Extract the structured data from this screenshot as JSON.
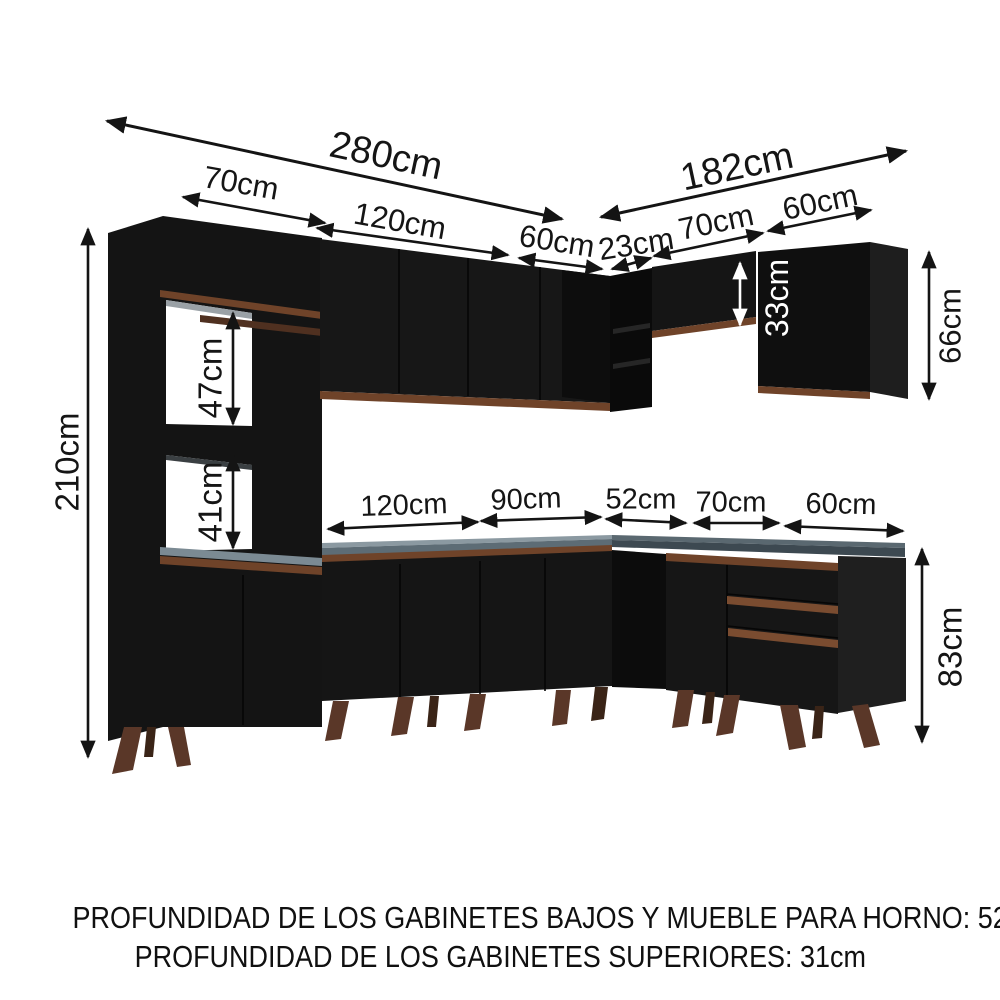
{
  "diagram": {
    "type": "kitchen-cabinet-dimension-diagram",
    "dimensions": {
      "left_run_total": "280cm",
      "right_run_total": "182cm",
      "top_row": {
        "tall_cabinet_width": "70cm",
        "upper_cabinet_120": "120cm",
        "upper_cabinet_60": "60cm",
        "corner_shelf_width": "23cm",
        "upper_cabinet_70": "70cm",
        "upper_cabinet_60_right": "60cm"
      },
      "heights": {
        "tall_cabinet_height": "210cm",
        "upper_niche": "47cm",
        "lower_niche": "41cm",
        "small_upper_cabinet": "33cm",
        "large_upper_cabinet": "66cm",
        "base_cabinet_height": "83cm"
      },
      "counter_row": {
        "base_120": "120cm",
        "base_90": "90cm",
        "base_52": "52cm",
        "base_70": "70cm",
        "base_60": "60cm"
      }
    },
    "footnotes": {
      "line1": "PROFUNDIDAD DE LOS GABINETES BAJOS Y MUEBLE PARA HORNO: 52cm",
      "line2": "PROFUNDIDAD DE LOS GABINETES SUPERIORES: 31cm"
    },
    "colors": {
      "cabinet_black": "#141414",
      "wood_trim": "#6f4329",
      "drawer_trim": "#7a4c30",
      "countertop_left": "#5d6c75",
      "countertop_right": "#3d4951",
      "legs": "#5a3728",
      "dimension_text": "#151515",
      "background": "#ffffff"
    }
  }
}
